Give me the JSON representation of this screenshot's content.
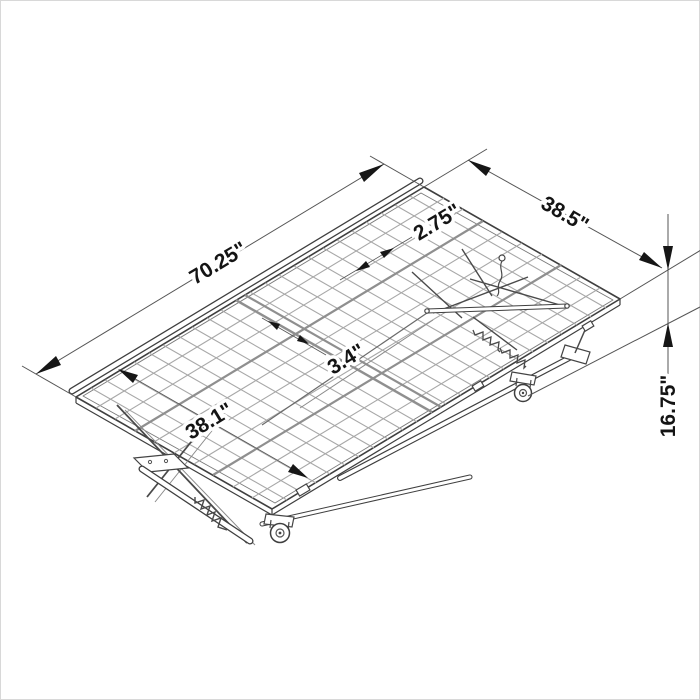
{
  "diagram": {
    "type": "isometric-dimension-drawing",
    "subject": "folding trundle bed frame with wire mesh deck, scissor legs and casters",
    "background_color": "#ffffff",
    "border_color": "#d8d8d8",
    "frame_color": "#3f3f3f",
    "mesh_color": "#a8a8a8",
    "dimension_line_color": "#555555",
    "arrow_color": "#161616",
    "label_color": "#141414",
    "dimensions": {
      "length": "70.25\"",
      "width": "38.5\"",
      "wire_spacing": "2.75\"",
      "wire_gap": "3.4\"",
      "inner_width": "38.1\"",
      "height": "16.75\""
    }
  }
}
